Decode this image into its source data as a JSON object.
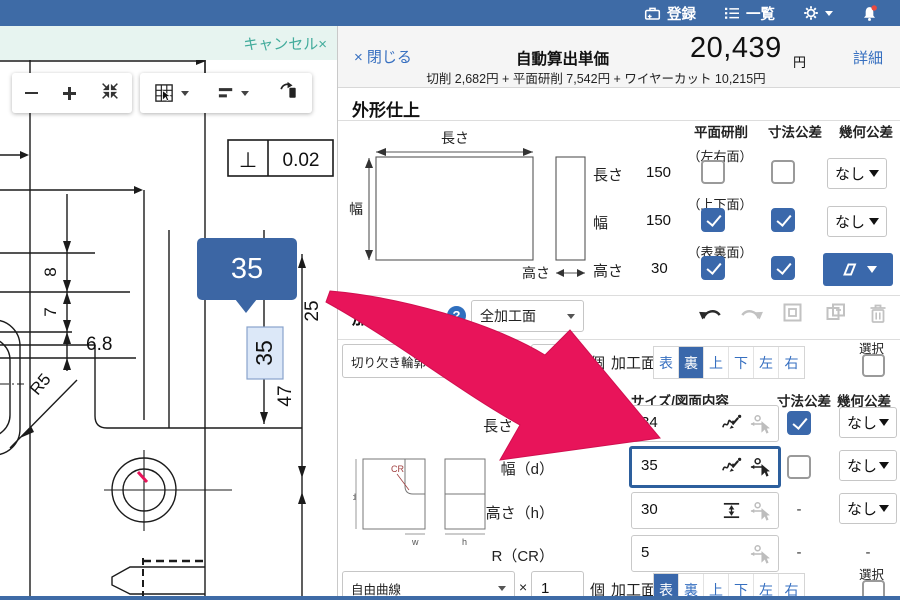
{
  "topbar": {
    "register": "登録",
    "list": "一覧"
  },
  "cad": {
    "cancel": "キャンセル×",
    "tooltip": "35",
    "perp_symbol": "⊥",
    "tolerance": "0.02",
    "dim_8": "8",
    "dim_7": "7",
    "dim_6_8": "6.8",
    "dim_r5": "R5",
    "dim_35": "35",
    "dim_25": "25",
    "dim_47": "47"
  },
  "header": {
    "close": "× 閉じる",
    "title": "自動算出単価",
    "price": "20,439",
    "yen": "円",
    "detail": "詳細",
    "breakdown": "切削 2,682円 + 平面研削 7,542円 + ワイヤーカット 10,215円"
  },
  "finish": {
    "title": "外形仕上",
    "diagram": {
      "length": "長さ",
      "width": "幅",
      "height": "高さ"
    },
    "cols": {
      "grind": "平面研削",
      "dim_tol": "寸法公差",
      "geo_tol": "幾何公差"
    },
    "faces": [
      "（左右面）",
      "（上下面）",
      "（表裏面）"
    ],
    "rows": [
      {
        "label": "長さ",
        "value": "150",
        "grind_checked": false,
        "dim_checked": false,
        "geo": "なし"
      },
      {
        "label": "幅",
        "value": "150",
        "grind_checked": true,
        "dim_checked": true,
        "geo": "なし"
      },
      {
        "label": "高さ",
        "value": "30",
        "grind_checked": true,
        "dim_checked": true,
        "geo": "▱"
      }
    ]
  },
  "shape": {
    "title": "加工形状",
    "help": "?",
    "scope": "全加工面",
    "times": "×",
    "unit": "個",
    "face_label": "加工面",
    "select_label": "選択",
    "faces": [
      "表",
      "裏",
      "上",
      "下",
      "左",
      "右"
    ],
    "row1": {
      "type": "切り欠き輪郭（通シ）",
      "count": "4",
      "selected_face": "裏"
    },
    "row2": {
      "type": "自由曲線",
      "count": "1",
      "selected_face": "表"
    },
    "table": {
      "col_size": "サイズ/図面内容",
      "col_dim_tol": "寸法公差",
      "col_geo_tol": "幾何公差",
      "dash": "-",
      "rows": [
        {
          "label": "長さ（w）",
          "value": "34",
          "dim_tol": "checked",
          "geo": "なし"
        },
        {
          "label": "幅（d）",
          "value": "35",
          "dim_tol": "unchecked",
          "geo": "なし"
        },
        {
          "label": "高さ（h）",
          "value": "30",
          "dim_tol": "-",
          "geo": "なし"
        },
        {
          "label": "R（CR）",
          "value": "5",
          "dim_tol": "-",
          "geo": "-"
        }
      ],
      "diagram": {
        "cr": "CR",
        "d": "d",
        "w": "w",
        "h": "h"
      }
    }
  },
  "colors": {
    "accent": "#3a68ab",
    "topbar": "#3e6ba6",
    "link": "#366fc0",
    "arrow": "#e8145a",
    "cancel": "#43ac9c"
  }
}
